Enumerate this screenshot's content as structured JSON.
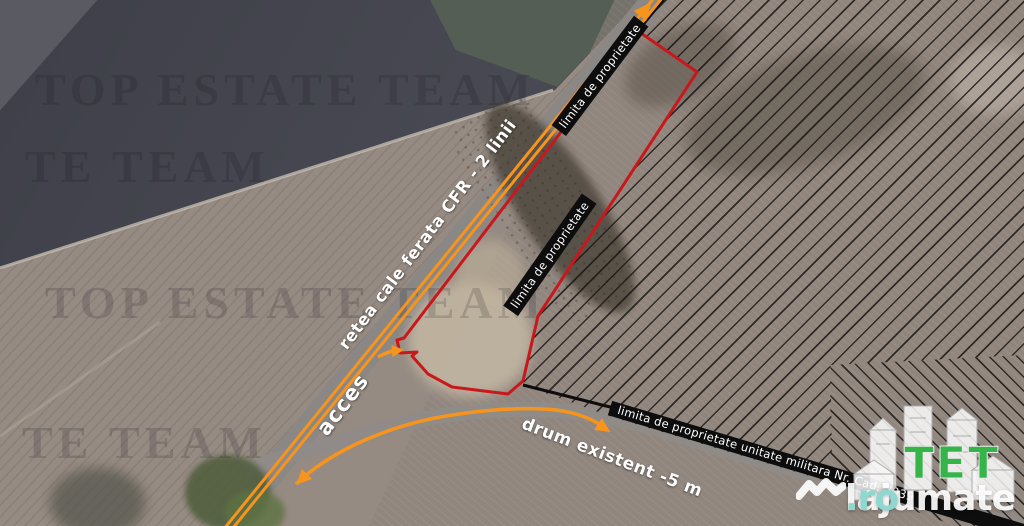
{
  "annotations": {
    "railway": "retea cale ferata CFR - 2 linii",
    "access": "acces",
    "road": "drum existent -5 m",
    "property_top": "limita de proprietate",
    "property_mid": "limita de proprietate",
    "military": "limita de proprietate unitate militara Nr. Cad. 2039"
  },
  "watermarks": {
    "row1": "TOP ESTATE TEAM",
    "row2": "TE TEAM",
    "row3": "TOP ESTATE TEAM",
    "row4": "TE TEAM"
  },
  "logo": {
    "brand": "lajumate",
    "tld": ".ro",
    "estate_letters": "TET"
  },
  "colors": {
    "railway_orange": "#f7941d",
    "boundary_red": "#c9181b",
    "military_band_black": "#0d0d0d",
    "label_white": "#ffffff",
    "estate_green": "#35b44a",
    "tld_teal": "#8fd8cf"
  }
}
